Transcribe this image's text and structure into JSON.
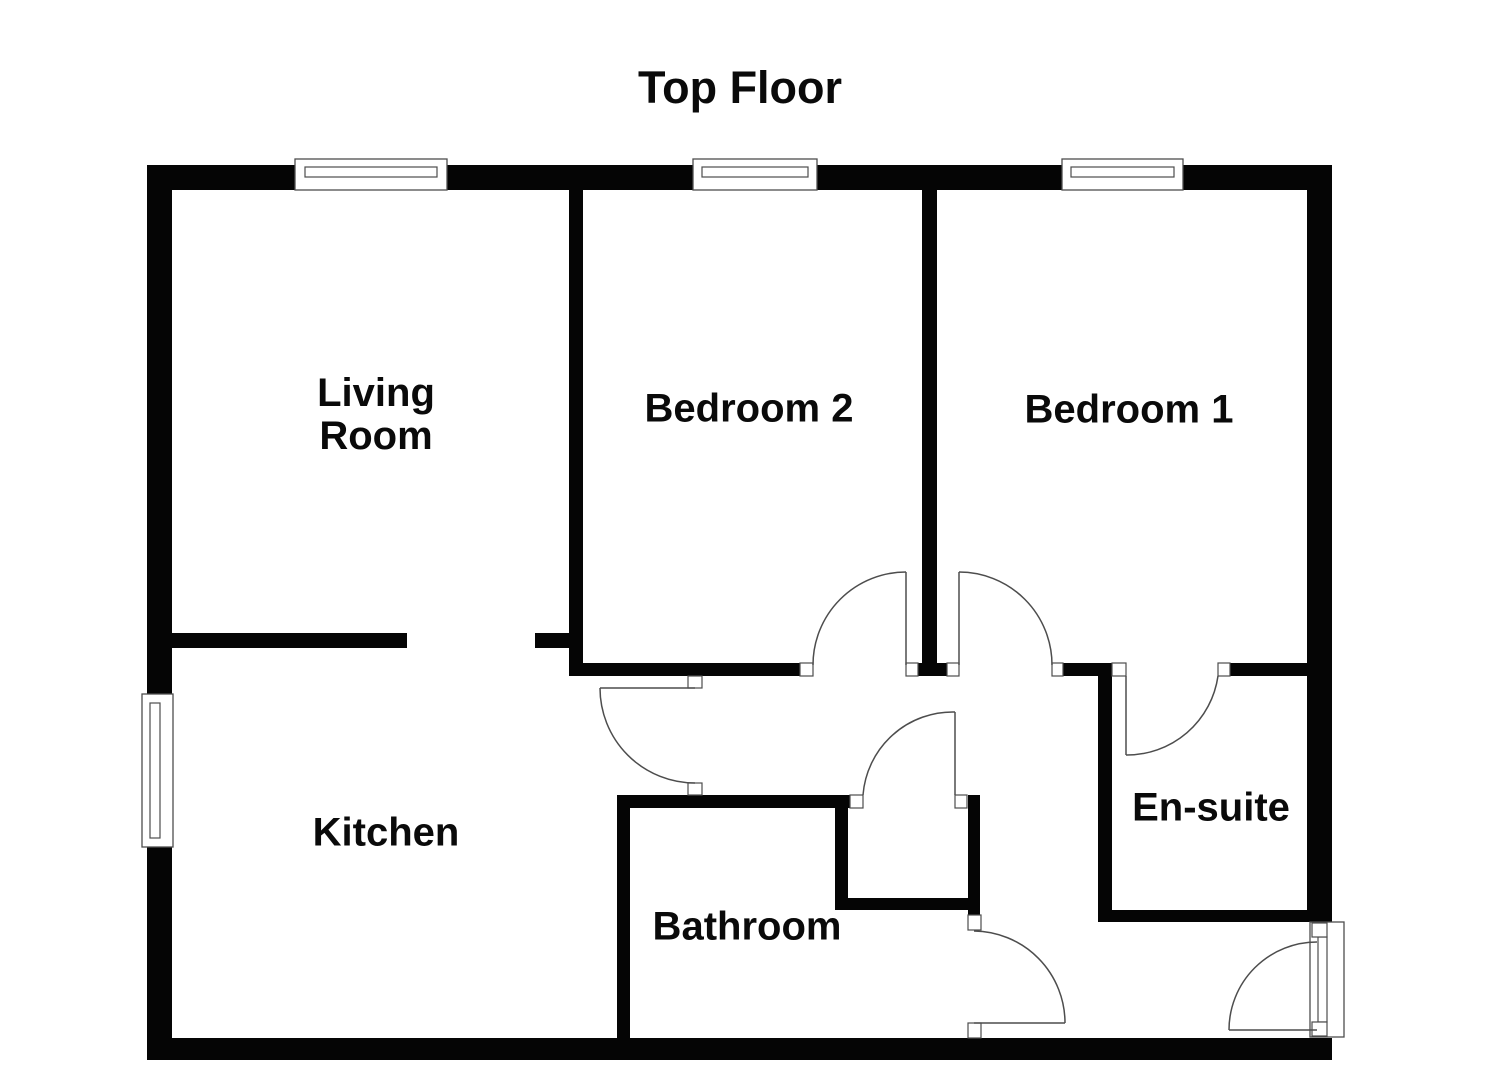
{
  "title": {
    "text": "Top Floor",
    "x": 740,
    "y": 88
  },
  "rooms": [
    {
      "id": "living-room",
      "label": "Living\nRoom",
      "x": 376,
      "y": 415
    },
    {
      "id": "bedroom-2",
      "label": "Bedroom 2",
      "x": 749,
      "y": 409
    },
    {
      "id": "bedroom-1",
      "label": "Bedroom 1",
      "x": 1129,
      "y": 410
    },
    {
      "id": "kitchen",
      "label": "Kitchen",
      "x": 386,
      "y": 833
    },
    {
      "id": "bathroom",
      "label": "Bathroom",
      "x": 747,
      "y": 927
    },
    {
      "id": "en-suite",
      "label": "En-suite",
      "x": 1211,
      "y": 808
    }
  ],
  "theme": {
    "background": "#ffffff",
    "wall_color": "#050505",
    "line_color": "#4d4d4d",
    "text_color": "#0a0a0a"
  },
  "floorplan": {
    "walls": [
      {
        "name": "wall-top",
        "x": 147,
        "y": 165,
        "w": 1185,
        "h": 25
      },
      {
        "name": "wall-left",
        "x": 147,
        "y": 165,
        "w": 25,
        "h": 895
      },
      {
        "name": "wall-bottom",
        "x": 147,
        "y": 1038,
        "w": 1185,
        "h": 22
      },
      {
        "name": "wall-right-upper",
        "x": 1307,
        "y": 165,
        "w": 25,
        "h": 757
      },
      {
        "name": "wall-living-kitchen",
        "x": 172,
        "y": 633,
        "w": 235,
        "h": 15
      },
      {
        "name": "wall-living-kitchen-stub",
        "x": 535,
        "y": 633,
        "w": 48,
        "h": 15
      },
      {
        "name": "wall-living-bedroom2",
        "x": 569,
        "y": 190,
        "w": 14,
        "h": 486
      },
      {
        "name": "wall-bedroom2-south",
        "x": 583,
        "y": 663,
        "w": 217,
        "h": 13
      },
      {
        "name": "wall-bedroom1-bedroom2",
        "x": 922,
        "y": 190,
        "w": 15,
        "h": 473
      },
      {
        "name": "wall-bedroom-divider-foot",
        "x": 918,
        "y": 663,
        "w": 29,
        "h": 13
      },
      {
        "name": "wall-hall-north",
        "x": 1063,
        "y": 663,
        "w": 35,
        "h": 13
      },
      {
        "name": "wall-hall-ensuite",
        "x": 1098,
        "y": 663,
        "w": 14,
        "h": 259
      },
      {
        "name": "wall-bedroom1-ensuite",
        "x": 1230,
        "y": 663,
        "w": 77,
        "h": 13
      },
      {
        "name": "wall-bathroom-north",
        "x": 617,
        "y": 795,
        "w": 233,
        "h": 13
      },
      {
        "name": "wall-bathroom-west",
        "x": 617,
        "y": 795,
        "w": 13,
        "h": 243
      },
      {
        "name": "wall-closet-west",
        "x": 835,
        "y": 795,
        "w": 13,
        "h": 115
      },
      {
        "name": "wall-closet-south",
        "x": 835,
        "y": 898,
        "w": 145,
        "h": 12
      },
      {
        "name": "wall-closet-east",
        "x": 968,
        "y": 795,
        "w": 12,
        "h": 120
      },
      {
        "name": "wall-ensuite-south",
        "x": 1098,
        "y": 910,
        "w": 212,
        "h": 12
      }
    ],
    "windows": [
      {
        "name": "window-living-room",
        "x": 295,
        "y": 159,
        "w": 152,
        "h": 31,
        "bar": {
          "x": 305,
          "y": 167,
          "w": 132,
          "h": 10
        }
      },
      {
        "name": "window-bedroom2",
        "x": 693,
        "y": 159,
        "w": 124,
        "h": 31,
        "bar": {
          "x": 702,
          "y": 167,
          "w": 106,
          "h": 10
        }
      },
      {
        "name": "window-bedroom1",
        "x": 1062,
        "y": 159,
        "w": 121,
        "h": 31,
        "bar": {
          "x": 1071,
          "y": 167,
          "w": 103,
          "h": 10
        }
      },
      {
        "name": "window-kitchen",
        "x": 142,
        "y": 694,
        "w": 31,
        "h": 153,
        "bar": {
          "x": 150,
          "y": 703,
          "w": 10,
          "h": 135
        }
      },
      {
        "name": "entry-door-frame",
        "x": 1310,
        "y": 922,
        "w": 34,
        "h": 115,
        "bar": {
          "x": 1318,
          "y": 937,
          "w": 9,
          "h": 85
        }
      }
    ],
    "jambs": [
      {
        "x": 800,
        "y": 663,
        "w": 13,
        "h": 13
      },
      {
        "x": 906,
        "y": 663,
        "w": 12,
        "h": 13
      },
      {
        "x": 947,
        "y": 663,
        "w": 12,
        "h": 13
      },
      {
        "x": 1052,
        "y": 663,
        "w": 11,
        "h": 13
      },
      {
        "x": 1112,
        "y": 663,
        "w": 14,
        "h": 13
      },
      {
        "x": 1218,
        "y": 663,
        "w": 12,
        "h": 13
      },
      {
        "x": 688,
        "y": 676,
        "w": 14,
        "h": 12
      },
      {
        "x": 688,
        "y": 783,
        "w": 14,
        "h": 12
      },
      {
        "x": 850,
        "y": 795,
        "w": 13,
        "h": 13
      },
      {
        "x": 955,
        "y": 795,
        "w": 12,
        "h": 13
      },
      {
        "x": 968,
        "y": 915,
        "w": 13,
        "h": 15
      },
      {
        "x": 968,
        "y": 1023,
        "w": 13,
        "h": 15
      },
      {
        "x": 1312,
        "y": 923,
        "w": 15,
        "h": 14
      },
      {
        "x": 1312,
        "y": 1022,
        "w": 15,
        "h": 14
      }
    ],
    "doors": [
      {
        "name": "door-bedroom2",
        "leaf": "M906 572 L906 665",
        "arc": "M906 572 A93 93 0 0 0 813 665"
      },
      {
        "name": "door-bedroom1",
        "leaf": "M959 572 L959 665",
        "arc": "M959 572 A93 93 0 0 1 1052 665"
      },
      {
        "name": "door-ensuite",
        "leaf": "M1126 676 L1126 755",
        "arc": "M1126 755 A92 92 0 0 0 1218 676"
      },
      {
        "name": "door-kitchen",
        "leaf": "M695 688 L600 688",
        "arc": "M600 688 A95 95 0 0 0 695 783"
      },
      {
        "name": "door-closet",
        "leaf": "M955 795 L955 712",
        "arc": "M955 712 A90 90 0 0 0 863 795"
      },
      {
        "name": "door-bathroom",
        "leaf": "M974 1023 L1065 1023",
        "arc": "M1065 1023 A92 92 0 0 0 974 931"
      },
      {
        "name": "door-entry",
        "leaf": "M1317 1030 L1229 1030",
        "arc": "M1229 1030 A88 88 0 0 1 1317 942"
      }
    ]
  }
}
